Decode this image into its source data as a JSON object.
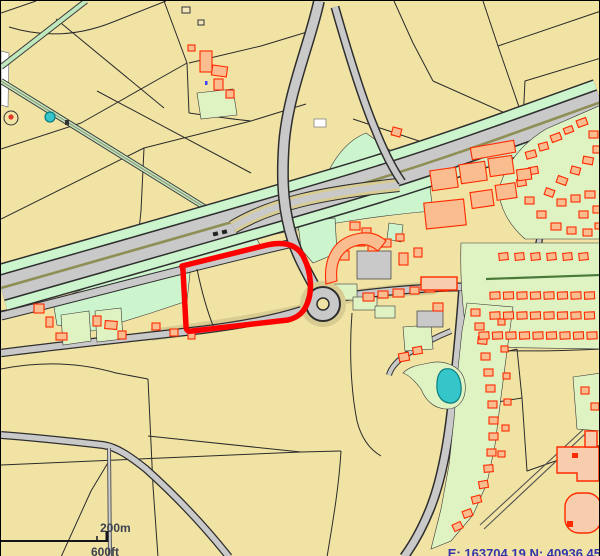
{
  "map_viewer": {
    "title": "Planning map extract",
    "scale_bar": {
      "metric_label": "200m",
      "imperial_label": "600ft"
    },
    "coordinate_readout": {
      "text": "E: 163704.19 N: 40936.45"
    },
    "features": {
      "site_boundary": "red-outlined development site",
      "motorway": "dual carriageway with verges",
      "roundabout": "junction roundabout",
      "pond": "pond",
      "village": "village with housing estates",
      "industrial_estate": "industrial units",
      "school": "large buildings"
    },
    "palette": {
      "field": "#f1e3a4",
      "field_line": "#2b2b2b",
      "green_open": "#ccf5cd",
      "green_garden": "#dff3c2",
      "road_fill": "#c9c9c9",
      "road_casing": "#2e2e2e",
      "road_verge": "#d8cc92",
      "median": "#8e8e55",
      "building_fill": "#fabd90",
      "building_large_fill": "#f8cdad",
      "building_stroke": "#ff2a00",
      "pond": "#35c6c9",
      "site_boundary": "#ff0000",
      "scale_text": "#3c4250",
      "coord_text": "#3434ad",
      "hedge": "#4a7a3a",
      "white_area": "#ffffff"
    }
  }
}
